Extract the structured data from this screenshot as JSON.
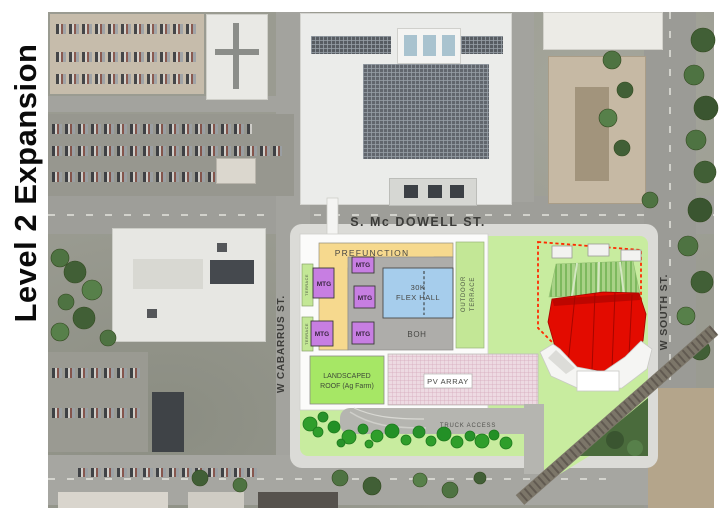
{
  "title": "Level 2 Expansion",
  "streets": {
    "mcdowell": "S. Mc DOWELL ST.",
    "cabarrus": "W CABARRUS ST.",
    "south": "W SOUTH ST."
  },
  "site": {
    "truck_access": "TRUCK ACCESS"
  },
  "program": {
    "prefunction": "PREFUNCTION",
    "flex_hall": [
      "30K",
      "FLEX HALL"
    ],
    "boh": "BOH",
    "outdoor_terrace": [
      "OUTDOOR",
      "TERRACE"
    ],
    "terrace_upper": "TERRACE",
    "terrace_lower": "TERRACE",
    "landscaped_roof": [
      "LANDSCAPED",
      "ROOF (Ag Farm)"
    ],
    "pv_array": "PV ARRAY",
    "mtg_rooms": [
      {
        "label": "MTG"
      },
      {
        "label": "MTG"
      },
      {
        "label": "MTG"
      },
      {
        "label": "MTG"
      },
      {
        "label": "MTG"
      }
    ]
  },
  "colors": {
    "site_green": "#c8ec9f",
    "terrace_green": "#c3e796",
    "landscaped_green": "#a6e765",
    "prefunction_tan": "#f6d98e",
    "meeting_purple": "#c77ee2",
    "flex_blue": "#a6cdec",
    "boh_gray": "#aeadaa",
    "pv_pink": "#eddae2",
    "theater_red": "#e30b00",
    "boundary_red": "#ff2a00",
    "lawn_seating_green": "#a9d287",
    "tree_green": "#2f9e2b"
  }
}
